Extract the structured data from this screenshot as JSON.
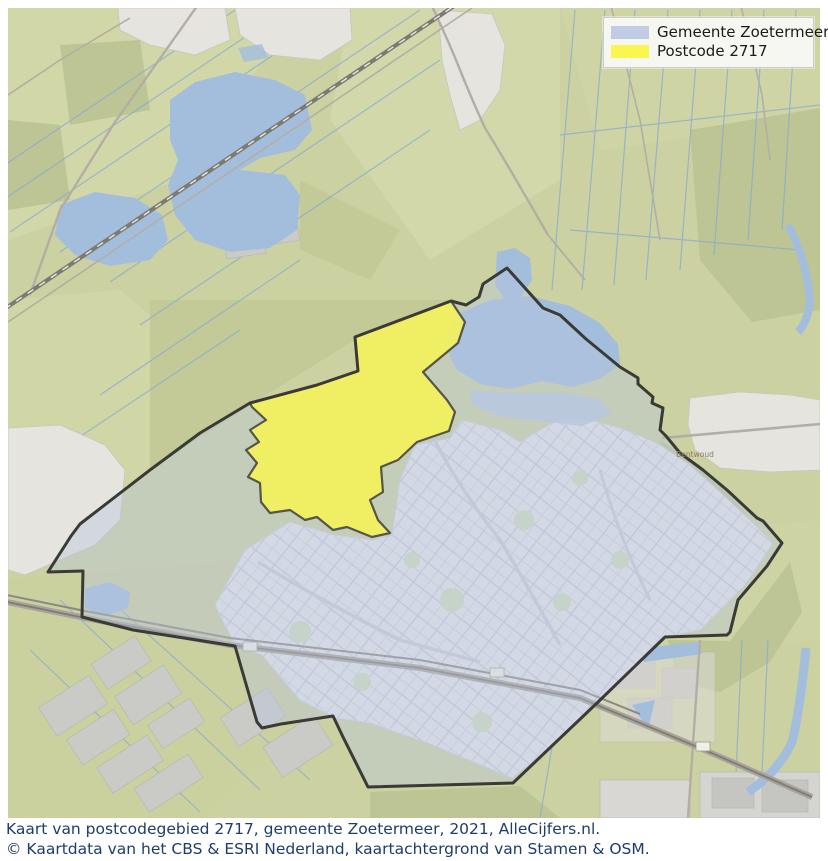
{
  "legend": {
    "items": [
      {
        "label": "Gemeente Zoetermeer",
        "color": "#bfcce3"
      },
      {
        "label": "Postcode 2717",
        "color": "#f9f64f"
      }
    ]
  },
  "captions": {
    "line1": "Kaart van postcodegebied 2717, gemeente Zoetermeer, 2021, AlleCijfers.nl.",
    "line2": "© Kaartdata van het CBS & ESRI Nederland, kaartachtergrond van Stamen & OSM."
  },
  "map": {
    "labels": [
      {
        "text": "Bentwoud"
      }
    ],
    "colors": {
      "municipality_fill": "#b9c6de",
      "municipality_border": "#3a3a36",
      "postcode_fill": "#f8f552",
      "postcode_border": "#55554a",
      "water": "#a3bedd",
      "fields": "#ccd1a1",
      "caption_text": "#1d3d6d"
    }
  }
}
